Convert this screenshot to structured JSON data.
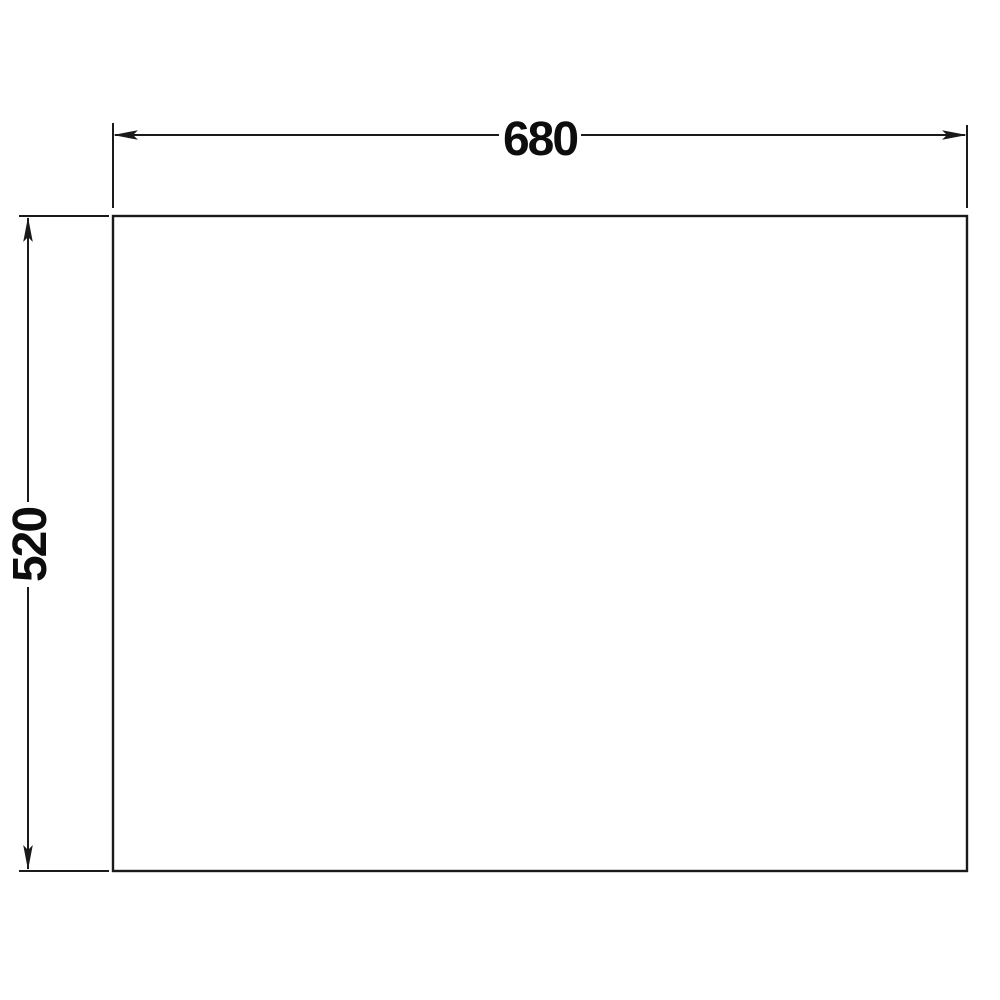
{
  "drawing": {
    "width_dimension": {
      "label": "680"
    },
    "height_dimension": {
      "label": "520"
    },
    "colors": {
      "line": "#1a1a1a",
      "text": "#0d0d0d",
      "background": "#ffffff"
    }
  }
}
